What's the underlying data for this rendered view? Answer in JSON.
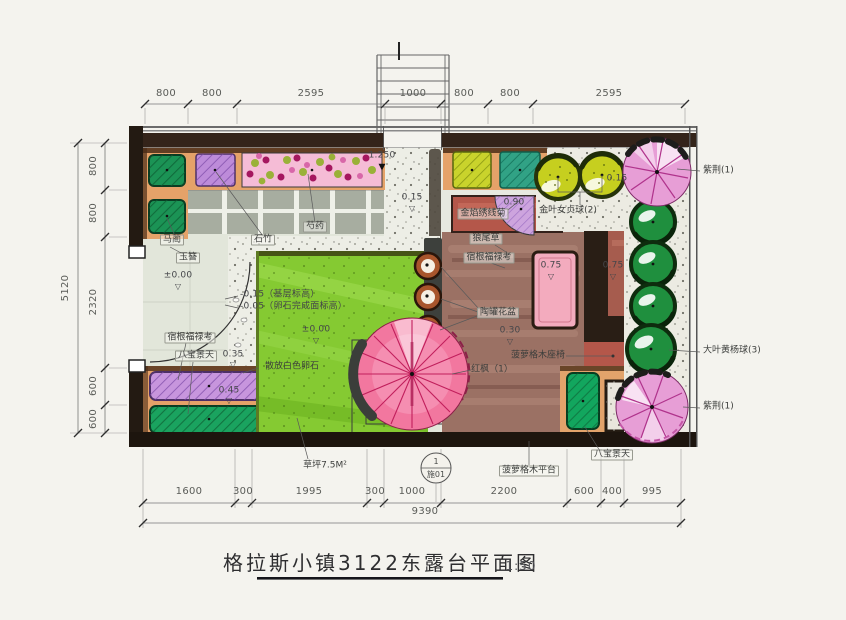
{
  "title": {
    "text": "格拉斯小镇3122东露台平面图",
    "scale": "1:50"
  },
  "dims": {
    "top": [
      "800",
      "800",
      "2595",
      "1000",
      "800",
      "800",
      "2595"
    ],
    "left": [
      "800",
      "800",
      "2320",
      "600",
      "600"
    ],
    "left_total": "5120",
    "bottom": [
      "1600",
      "300",
      "1995",
      "300",
      "1000",
      "2200",
      "600",
      "400",
      "995"
    ],
    "bottom_total": "9390"
  },
  "levels": {
    "stair": "1.250",
    "terrace_top": "0.15",
    "terrace_right": "0.15",
    "court_a": "±0.00",
    "lawn": "±0.00",
    "strip_a": "0.35",
    "strip_b": "0.45",
    "base": "-0.15（基层标高）",
    "pebble_face": "-0.05（卵石完成面标高）",
    "fan": "0.90",
    "bench_a": "0.75",
    "bench_b": "0.75",
    "deck": "0.30"
  },
  "labels": {
    "ma_lin": "马蔺",
    "shi_zhu": "石竹",
    "shao_yao": "芍药",
    "yu_zan": "玉簪",
    "phlox_left": "宿根福禄考",
    "sedum_left": "八宝景天",
    "pebbles": "散放白色卵石",
    "lawn_area": "草坪7.5M²",
    "spirea": "金焰绣线菊",
    "privet": "金叶女贞球(2)",
    "fountain_grass": "狼尾草",
    "phlox_right": "宿根福禄考",
    "pots": "陶罐花盆",
    "bench": "菠萝格木座椅",
    "maple": "红枫（1）",
    "deck_label": "菠萝格木平台",
    "sedum_right": "八宝景天",
    "redbud_top": "紫荆(1)",
    "boxwood": "大叶黄杨球(3)",
    "redbud_bottom": "紫荆(1)"
  },
  "section_marker": {
    "num": "1",
    "sheet": "施01"
  },
  "icons": {
    "level_open": "▽",
    "level_filled": "▼"
  }
}
